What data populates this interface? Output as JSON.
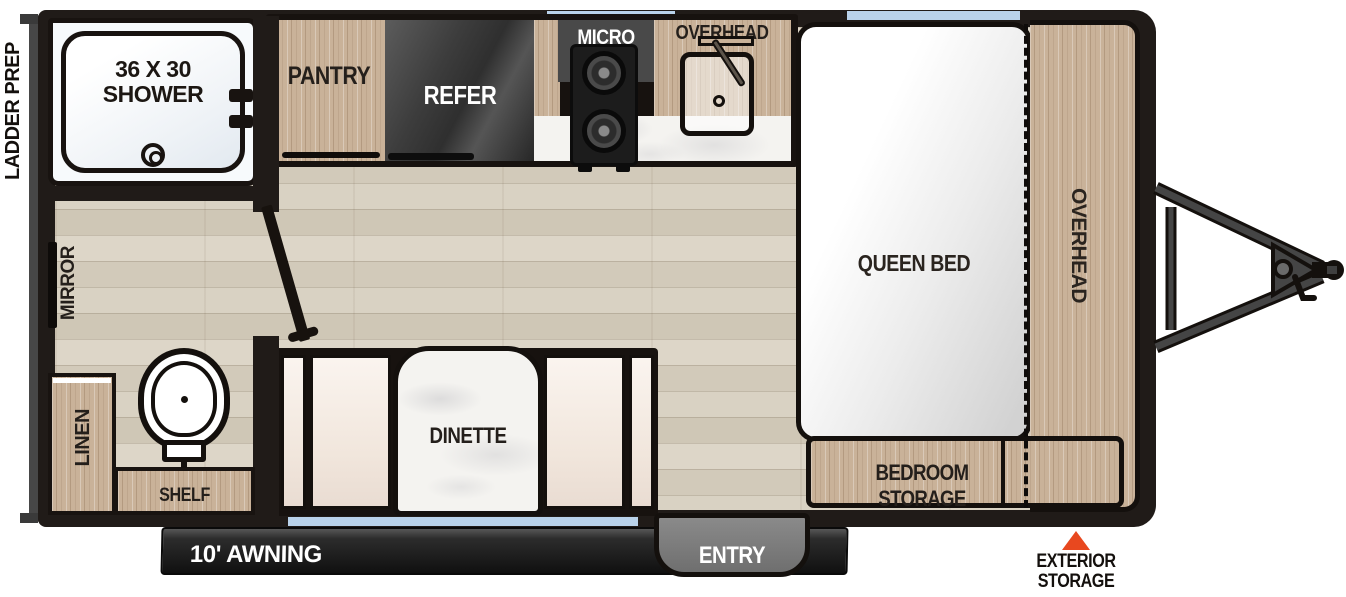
{
  "title": "Travel trailer floor plan",
  "exterior": {
    "ladder_prep": "LADDER PREP",
    "awning": "10' AWNING",
    "entry": "ENTRY",
    "exterior_storage_line1": "EXTERIOR",
    "exterior_storage_line2": "STORAGE"
  },
  "bathroom": {
    "shower_line1": "36 X 30",
    "shower_line2": "SHOWER",
    "mirror": "MIRROR",
    "linen": "LINEN",
    "shelf": "SHELF"
  },
  "kitchen": {
    "pantry": "PANTRY",
    "refer": "REFER",
    "micro": "MICRO",
    "overhead": "OVERHEAD"
  },
  "bedroom": {
    "queen_bed": "QUEEN BED",
    "overhead": "OVERHEAD",
    "bedroom_storage": "BEDROOM STORAGE"
  },
  "dinette": {
    "label": "DINETTE"
  },
  "colors": {
    "wall": "#201b18",
    "floor": "#d9d1c2",
    "wood": "#c9b299",
    "appliance_gray": "#494949",
    "entry_gray": "#7d7d7d",
    "window_blue": "#b9d2ea",
    "marble_white": "#f4f3f0",
    "accent_red": "#e8481f"
  }
}
